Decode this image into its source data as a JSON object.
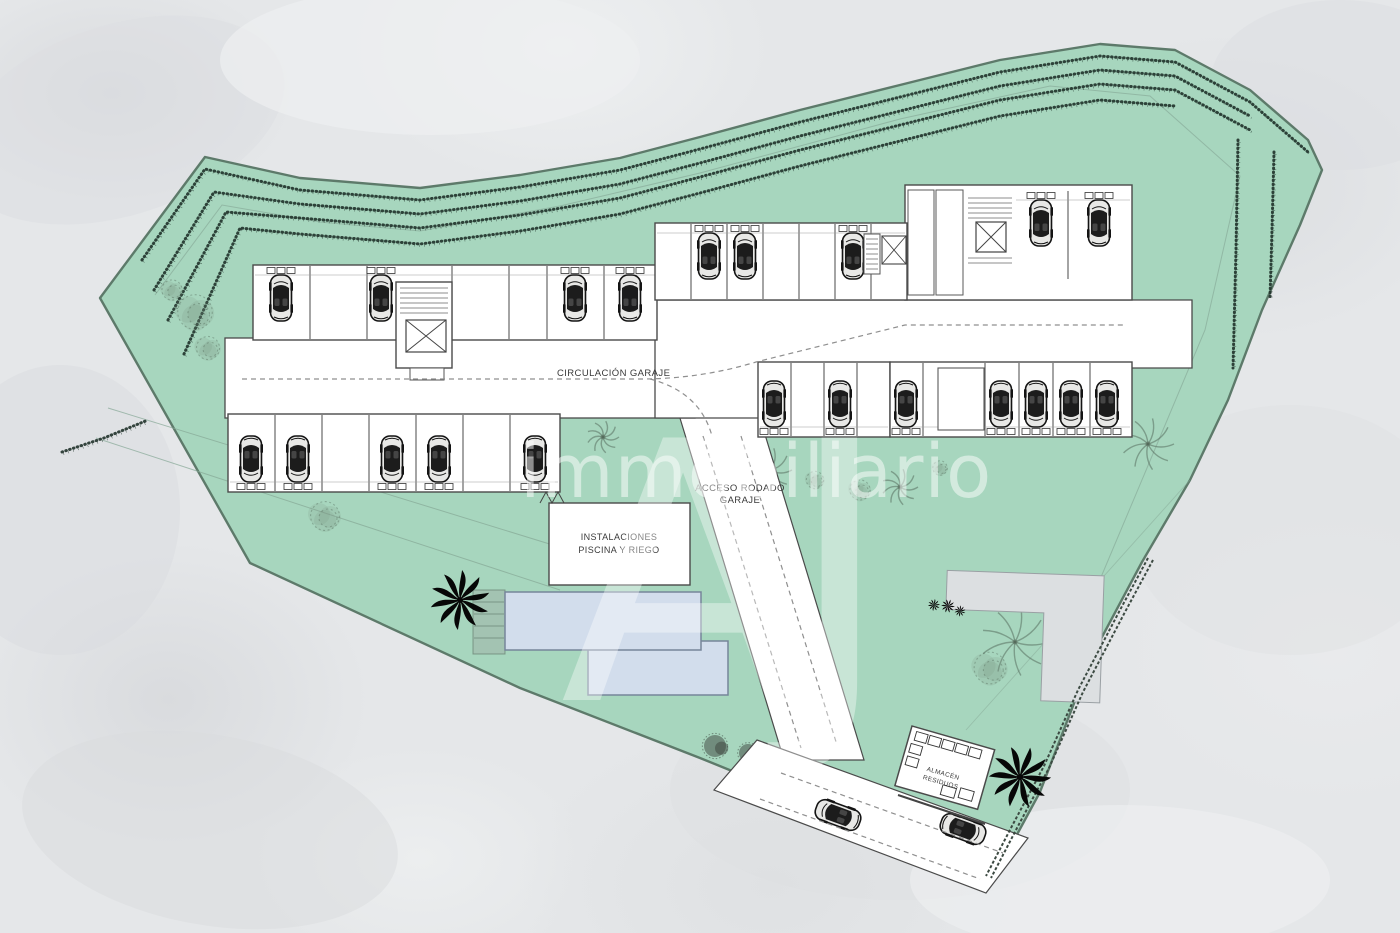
{
  "labels": {
    "circulacion": "CIRCULACIÓN GARAJE",
    "acceso_line1": "ACCESO RODADO",
    "acceso_line2": "GARAJE",
    "instalaciones_line1": "INSTALACIONES",
    "instalaciones_line2": "PISCINA Y RIEGO",
    "almacen_line1": "ALMACÉN",
    "almacen_line2": "RESIDUOS"
  },
  "watermark": {
    "text": "immobiliario",
    "monogram": "AJ"
  },
  "colors": {
    "bg": "#e5e7e9",
    "site-green": "#a7d6be",
    "site-outline": "#5d7a6a",
    "floor-white": "#ffffff",
    "wall-line": "#4a4a4a",
    "pool-fill": "#d2ddec",
    "pool-stroke": "#76859a",
    "terrace-gray": "#dcdfe1",
    "dash-gray": "#8f8f8f",
    "hatch-dark": "#20322a",
    "parcel-line": "#86a896",
    "car-dark": "#141414"
  }
}
